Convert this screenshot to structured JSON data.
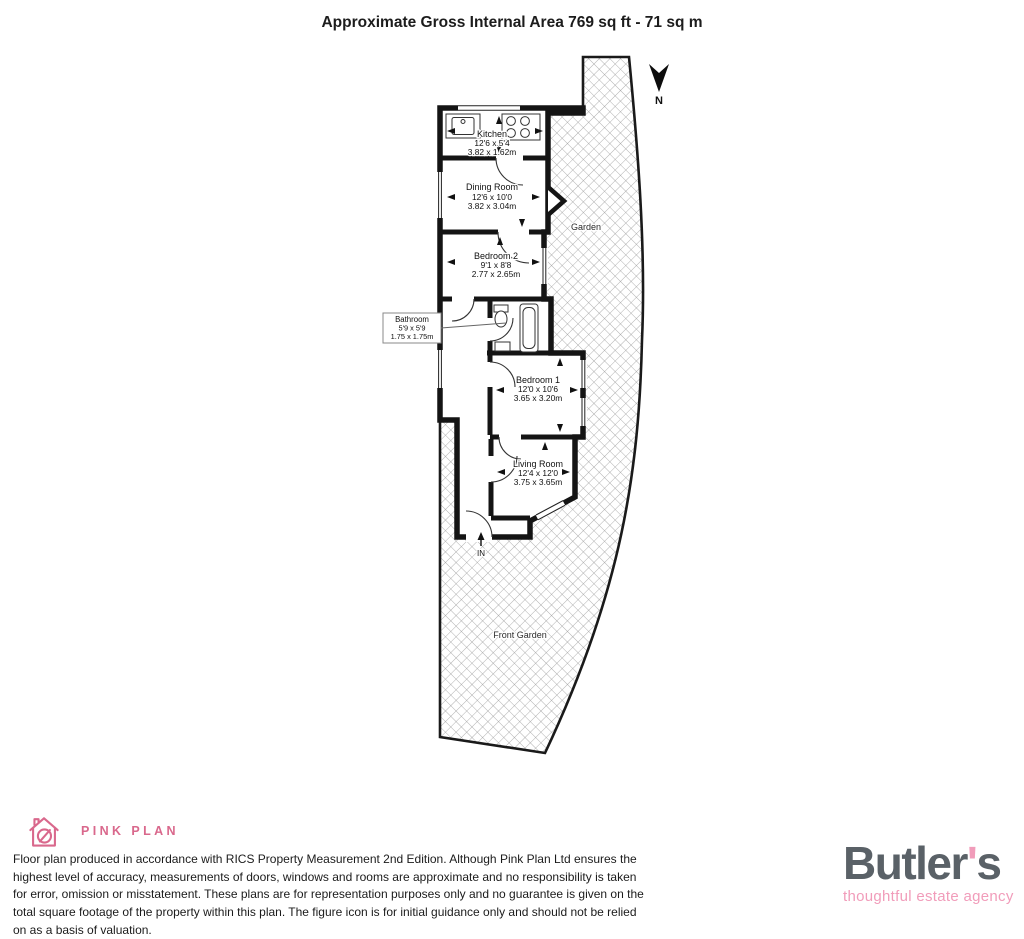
{
  "title": "Approximate Gross Internal Area 769 sq ft - 71 sq m",
  "compass": {
    "label": "N"
  },
  "rooms": {
    "kitchen": {
      "name": "Kitchen",
      "imperial": "12'6 x 5'4",
      "metric": "3.82 x 1.62m"
    },
    "dining": {
      "name": "Dining Room",
      "imperial": "12'6 x 10'0",
      "metric": "3.82 x 3.04m"
    },
    "bedroom2": {
      "name": "Bedroom 2",
      "imperial": "9'1 x 8'8",
      "metric": "2.77 x 2.65m"
    },
    "bathroom": {
      "name": "Bathroom",
      "imperial": "5'9 x 5'9",
      "metric": "1.75 x 1.75m"
    },
    "bedroom1": {
      "name": "Bedroom 1",
      "imperial": "12'0 x 10'6",
      "metric": "3.65 x 3.20m"
    },
    "living": {
      "name": "Living Room",
      "imperial": "12'4 x 12'0",
      "metric": "3.75 x 3.65m"
    }
  },
  "outdoor": {
    "rear": "Garden",
    "front": "Front Garden",
    "entrance": "IN"
  },
  "footer": {
    "brand": "PINK PLAN",
    "disclaimer": "Floor plan produced in accordance with RICS Property Measurement 2nd Edition. Although Pink Plan Ltd ensures the highest level of accuracy, measurements of doors, windows and rooms are approximate and no responsibility is taken for error, omission or misstatement. These plans are for representation purposes only and no guarantee is given on the total square footage of the property within this plan. The figure icon is for initial guidance only and should not be relied on as a basis of valuation.",
    "agency": {
      "name_pre": "Butler",
      "apostrophe": "'",
      "name_post": "s",
      "tagline": "thoughtful estate agency"
    }
  },
  "colors": {
    "pink_plan": "#d9688c",
    "butlers_gray": "#5a6167",
    "butlers_pink": "#f19cba",
    "wall": "#141414",
    "hatch": "#989898"
  }
}
